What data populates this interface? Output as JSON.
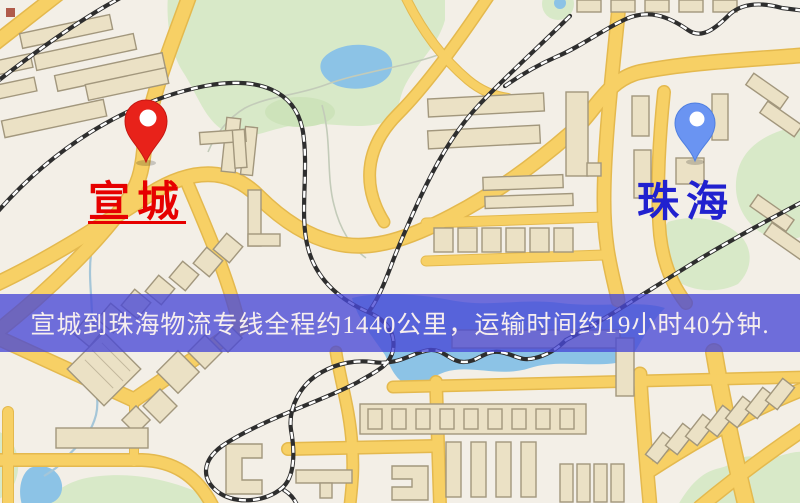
{
  "image": {
    "width": 800,
    "height": 503,
    "kind": "logistics-route-map"
  },
  "map": {
    "origin": {
      "label": "宣城",
      "pin_icon": "red-location-pin"
    },
    "destination": {
      "label": "珠海",
      "pin_icon": "blue-location-pin"
    }
  },
  "banner": {
    "text": "宣城到珠海物流专线全程约1440公里，运输时间约19小时40分钟.",
    "route_distance_km": "1440",
    "transit_time": "19小时40分钟"
  },
  "palette": {
    "map_bg": "#f3efe7",
    "road_fill": "#f7d065",
    "road_casing": "#e4b94e",
    "building_fill": "#ebe1c5",
    "building_stroke": "#a2977d",
    "green_area": "#d8e9c8",
    "green_area_dark": "#cde3ba",
    "water": "#8cc3e6",
    "rail_dark": "#2e2e2e",
    "rail_light": "#ffffff",
    "contour": "#c3cbb9",
    "river": "#a5c6d8",
    "banner_bg": "rgba(72,72,214,0.78)",
    "banner_text": "#f6eeee",
    "pin_red": "#e8221a",
    "pin_red_stroke": "#c41711",
    "pin_blue": "#6a94f2",
    "pin_blue_stroke": "#4f7fe0",
    "label_red": "#e60000",
    "label_blue": "#2121cf"
  }
}
